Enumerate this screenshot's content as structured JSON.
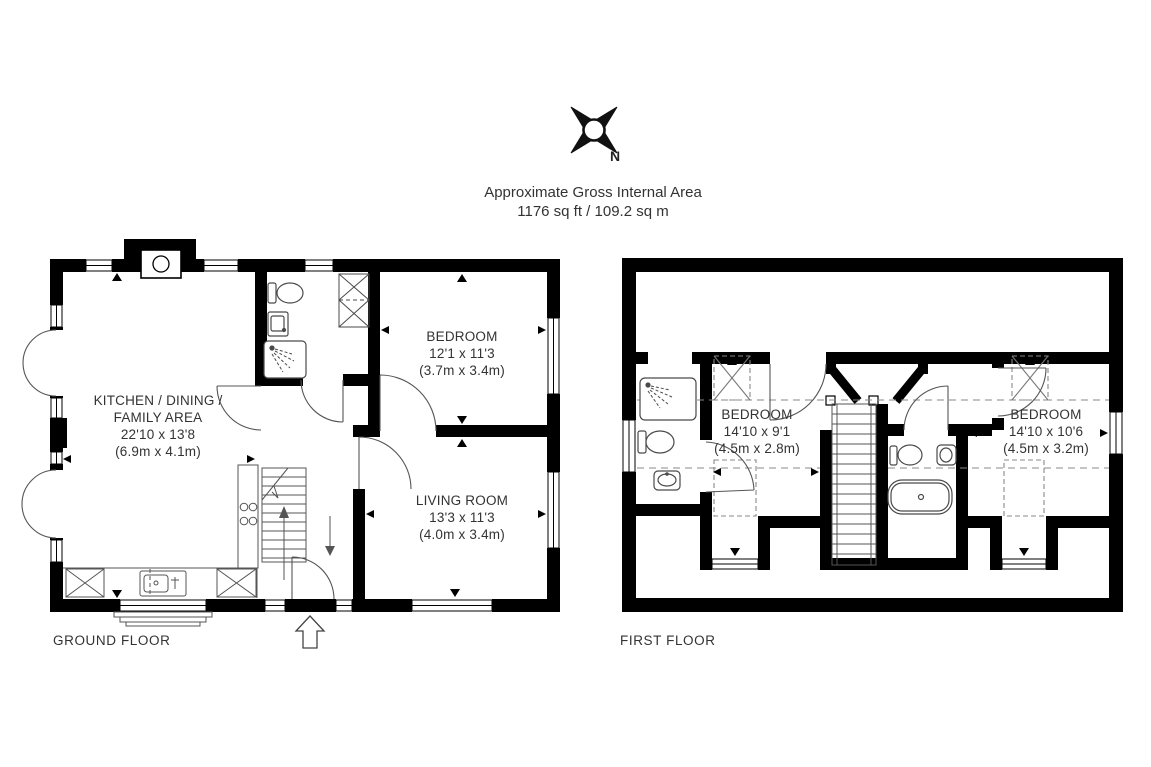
{
  "header": {
    "compass_label": "N",
    "title_line1": "Approximate Gross Internal Area",
    "title_line2": "1176 sq ft / 109.2 sq m"
  },
  "ground_floor": {
    "label": "GROUND FLOOR",
    "kitchen": {
      "name_line1": "KITCHEN / DINING /",
      "name_line2": "FAMILY AREA",
      "dims_imperial": "22'10 x 13'8",
      "dims_metric": "(6.9m x 4.1m)"
    },
    "bedroom": {
      "name": "BEDROOM",
      "dims_imperial": "12'1 x 11'3",
      "dims_metric": "(3.7m x 3.4m)"
    },
    "living_room": {
      "name": "LIVING ROOM",
      "dims_imperial": "13'3 x 11'3",
      "dims_metric": "(4.0m x 3.4m)"
    }
  },
  "first_floor": {
    "label": "FIRST FLOOR",
    "bedroom_left": {
      "name": "BEDROOM",
      "dims_imperial": "14'10 x 9'1",
      "dims_metric": "(4.5m x 2.8m)"
    },
    "bedroom_right": {
      "name": "BEDROOM",
      "dims_imperial": "14'10 x 10'6",
      "dims_metric": "(4.5m x 3.2m)"
    }
  },
  "colors": {
    "wall": "#000000",
    "fixture_line": "#4a4a4a",
    "text": "#333333",
    "background": "#ffffff"
  }
}
